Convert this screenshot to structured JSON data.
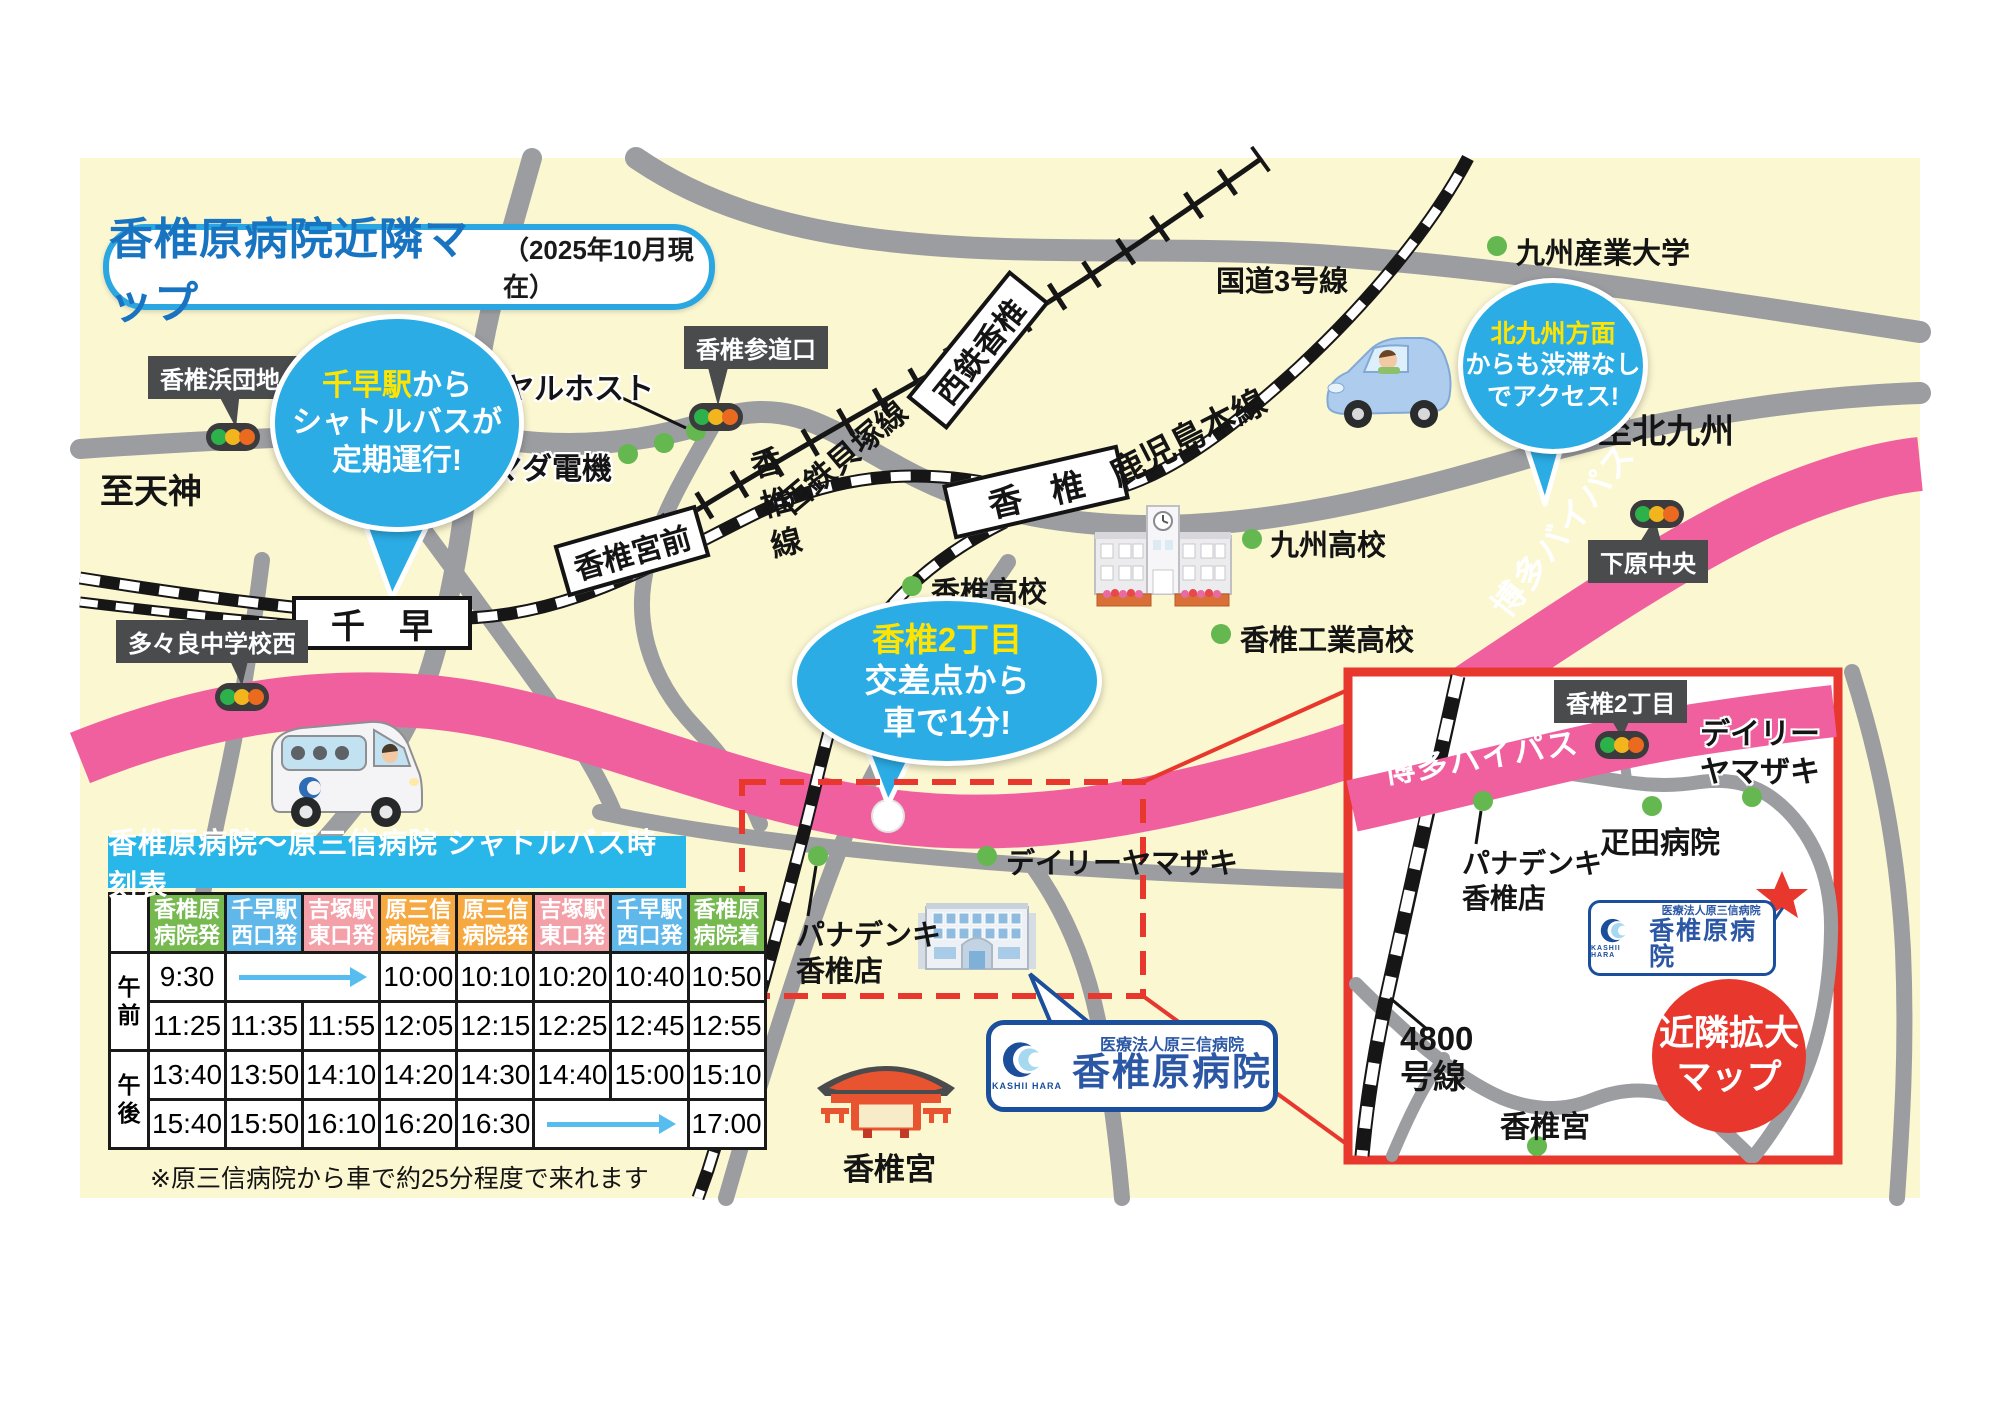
{
  "title": {
    "main": "香椎原病院近隣マップ",
    "date_note": "（2025年10月現在）"
  },
  "balloons": {
    "chihaya": {
      "hl": "千早駅",
      "l1rest": "から",
      "l2": "シャトルバスが",
      "l3": "定期運行!"
    },
    "kashii2": {
      "hl": "香椎2丁目",
      "l2": "交差点から",
      "l3": "車で1分!"
    },
    "kitakyushu": {
      "hl": "北九州方面",
      "l2": "からも渋滞なし",
      "l3": "でアクセス!"
    }
  },
  "stations": {
    "chihaya": "千早",
    "miyamae": "香椎宮前",
    "kashii": "香椎",
    "nishitetsu_kashii": "西鉄香椎"
  },
  "signs": {
    "hamadanchi": "香椎浜団地入口",
    "sandoguchi": "香椎参道口",
    "tatara": "多々良中学校西",
    "shimohara": "下原中央",
    "kashii2_inset": "香椎2丁目"
  },
  "roads": {
    "kokudo3": "国道3号線",
    "kagoshima": "鹿児島本線",
    "kaizuka": "西鉄貝塚線",
    "kashii_line": "香椎線",
    "bypass_main": "博多バイパス",
    "bypass_inset": "博多バイパス",
    "to_tenjin": "至天神",
    "to_kitakyushu": "至北九州",
    "r4800": "4800\n号線"
  },
  "pois": {
    "royal_host": "ロイヤルホスト",
    "yamada": "ヤマダ電機",
    "sangyo_univ": "九州産業大学",
    "kyushu_hs": "九州高校",
    "kashii_hs": "香椎高校",
    "kogyo_hs": "香椎工業高校",
    "daily_main": "デイリーヤマザキ",
    "daily_inset": "デイリー\nヤマザキ",
    "panadenki_main": "パナデンキ\n香椎店",
    "panadenki_inset": "パナデンキ\n香椎店",
    "hikita": "疋田病院",
    "kashiigu_main": "香椎宮",
    "kashiigu_inset": "香椎宮"
  },
  "hospital": {
    "org": "医療法人原三信病院",
    "name": "香椎原病院",
    "logo_text": "KASHII HARA"
  },
  "inset": {
    "zoom_title": "近隣拡大\nマップ"
  },
  "timetable": {
    "title": "香椎原病院〜原三信病院 シャトルバス時刻表",
    "headers": [
      {
        "text": "香椎原\n病院発",
        "color": "green"
      },
      {
        "text": "千早駅\n西口発",
        "color": "blue"
      },
      {
        "text": "吉塚駅\n東口発",
        "color": "pink"
      },
      {
        "text": "原三信\n病院着",
        "color": "orange"
      },
      {
        "text": "原三信\n病院発",
        "color": "orange"
      },
      {
        "text": "吉塚駅\n東口発",
        "color": "pink"
      },
      {
        "text": "千早駅\n西口発",
        "color": "blue"
      },
      {
        "text": "香椎原\n病院着",
        "color": "green"
      }
    ],
    "blocks": [
      {
        "period": "午前",
        "rows": [
          [
            "9:30",
            "ARROW",
            "ARROW",
            "10:00",
            "10:10",
            "10:20",
            "10:40",
            "10:50"
          ],
          [
            "11:25",
            "11:35",
            "11:55",
            "12:05",
            "12:15",
            "12:25",
            "12:45",
            "12:55"
          ]
        ]
      },
      {
        "period": "午後",
        "rows": [
          [
            "13:40",
            "13:50",
            "14:10",
            "14:20",
            "14:30",
            "14:40",
            "15:00",
            "15:10"
          ],
          [
            "15:40",
            "15:50",
            "16:10",
            "16:20",
            "16:30",
            "ARROW",
            "ARROW",
            "17:00"
          ]
        ]
      }
    ],
    "note": "※原三信病院から車で約25分程度で来れます"
  }
}
